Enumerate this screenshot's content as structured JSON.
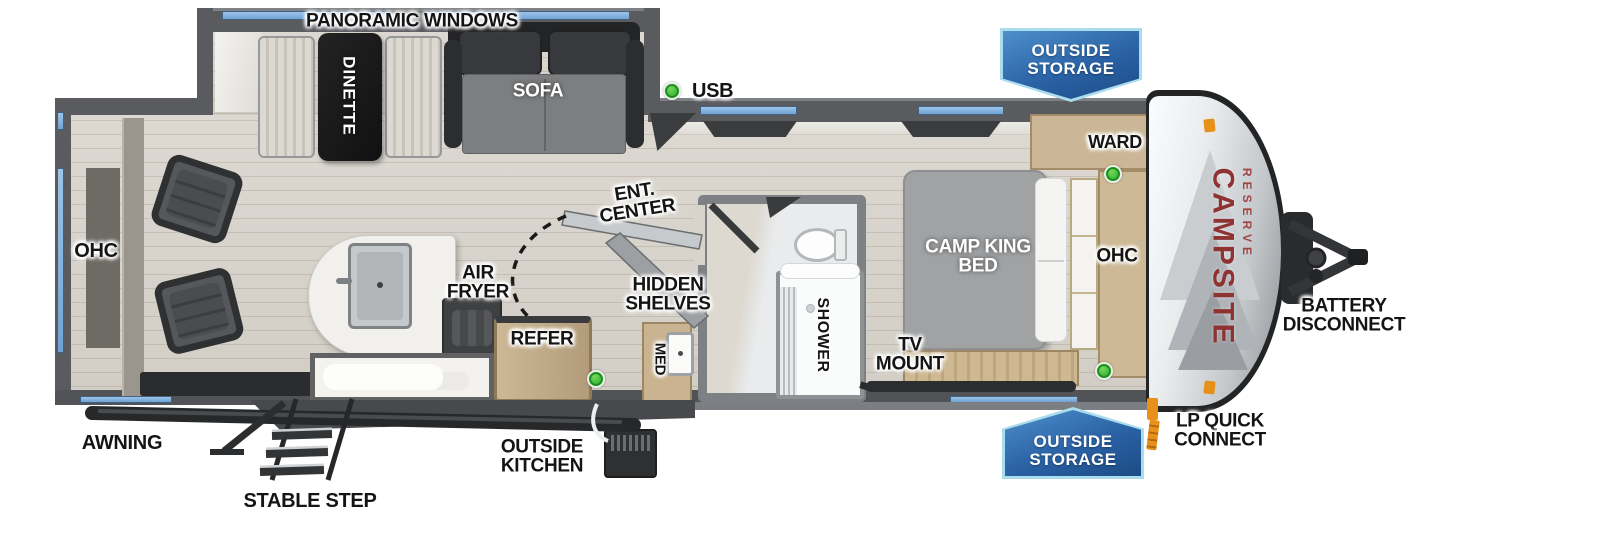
{
  "brand": {
    "name": "CAMPSITE",
    "series": "RESERVE"
  },
  "legend": {
    "usb": "USB"
  },
  "banners": {
    "outside_storage_top": "OUTSIDE STORAGE",
    "outside_storage_bottom": "OUTSIDE STORAGE"
  },
  "exterior": {
    "panoramic_windows": "PANORAMIC WINDOWS",
    "awning": "AWNING",
    "stable_step": "STABLE STEP",
    "outside_kitchen": "OUTSIDE KITCHEN",
    "lp_quick_connect": "LP QUICK CONNECT",
    "battery_disconnect": "BATTERY DISCONNECT"
  },
  "interior": {
    "dinette": "DINETTE",
    "sofa": "SOFA",
    "ohc_rear": "OHC",
    "air_fryer": "AIR FRYER",
    "refer": "REFER",
    "ent_center": "ENT. CENTER",
    "hidden_shelves": "HIDDEN SHELVES",
    "med": "MED",
    "shower": "SHOWER",
    "tv_mount": "TV MOUNT",
    "camp_king_bed": "CAMP KING BED",
    "ward": "WARD",
    "ohc_front": "OHC"
  },
  "icons": {
    "usb_indicator": "usb-dot-icon",
    "clearance_light": "orange-marker-icon"
  },
  "colors": {
    "window_blue": "#7fb2de",
    "banner_blue": "#2a62a5",
    "banner_border": "#a9dcec",
    "brand_red": "#8e3232",
    "usb_green": "#3fbe3c",
    "accent_orange": "#e8911a",
    "wall_gray": "#595b5f",
    "floor_wood": "#d8d4cc"
  }
}
